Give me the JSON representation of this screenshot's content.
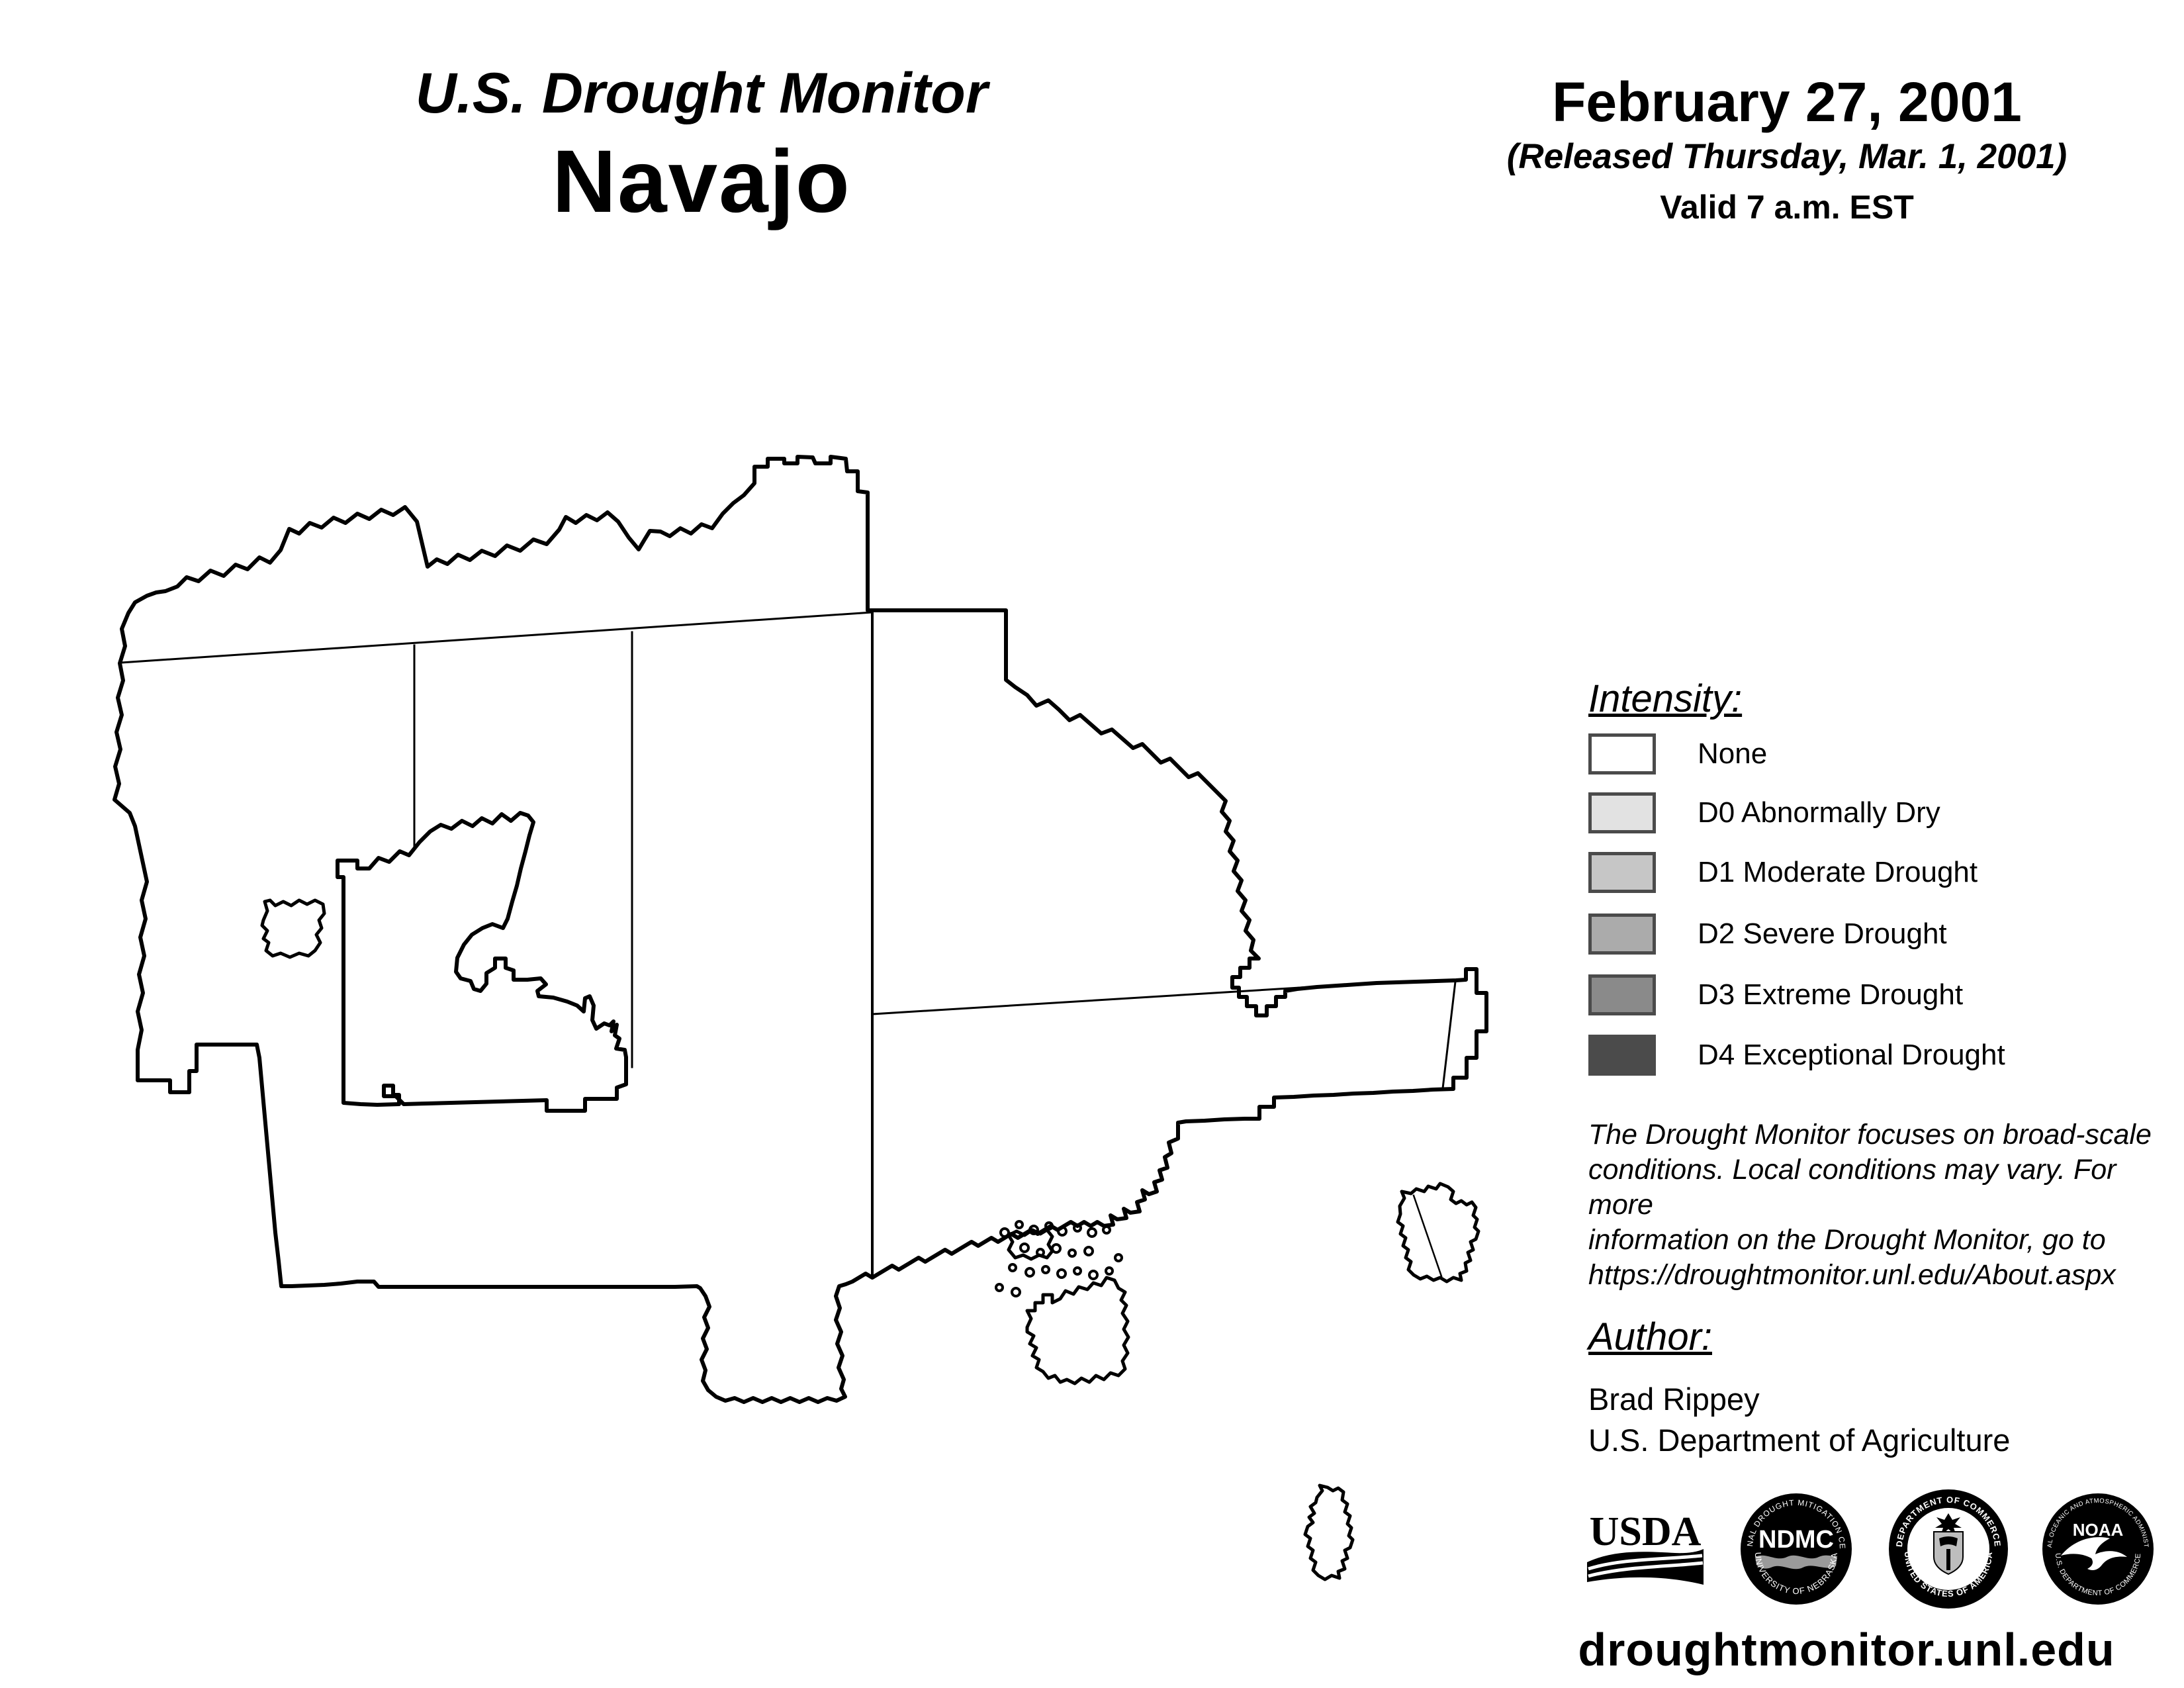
{
  "header": {
    "title_line1": "U.S. Drought Monitor",
    "title_line2": "Navajo",
    "date": "February 27, 2001",
    "released": "(Released Thursday, Mar. 1, 2001)",
    "valid": "Valid 7 a.m. EST"
  },
  "legend": {
    "heading": "Intensity:",
    "swatch_border": "#4b4b4b",
    "items": [
      {
        "label": "None",
        "color": "#ffffff"
      },
      {
        "label": "D0 Abnormally Dry",
        "color": "#e2e2e2"
      },
      {
        "label": "D1 Moderate Drought",
        "color": "#c6c6c6"
      },
      {
        "label": "D2 Severe Drought",
        "color": "#ababab"
      },
      {
        "label": "D3 Extreme Drought",
        "color": "#8a8a8a"
      },
      {
        "label": "D4 Exceptional Drought",
        "color": "#4b4b4b"
      }
    ]
  },
  "disclaimer": {
    "lines": [
      "The Drought Monitor focuses on broad-scale",
      "conditions. Local conditions may vary. For more",
      "information on the Drought Monitor, go to",
      "https://droughtmonitor.unl.edu/About.aspx"
    ]
  },
  "author": {
    "heading": "Author:",
    "name": "Brad Rippey",
    "organization": "U.S. Department of Agriculture"
  },
  "footer": {
    "url": "droughtmonitor.unl.edu"
  },
  "logos": {
    "usda": {
      "text": "USDA"
    },
    "ndmc": {
      "arc_top": "NATIONAL DROUGHT MITIGATION CENTER",
      "center": "NDMC",
      "arc_bottom": "UNIVERSITY OF NEBRASKA"
    },
    "commerce": {
      "arc_top": "DEPARTMENT OF COMMERCE",
      "arc_bottom": "UNITED STATES OF AMERICA"
    },
    "noaa": {
      "arc_top": "NATIONAL OCEANIC AND ATMOSPHERIC ADMINISTRATION",
      "center": "NOAA",
      "arc_bottom": "U.S. DEPARTMENT OF COMMERCE"
    }
  },
  "map": {
    "outline_color": "#000000",
    "fill_color": "#ffffff"
  }
}
